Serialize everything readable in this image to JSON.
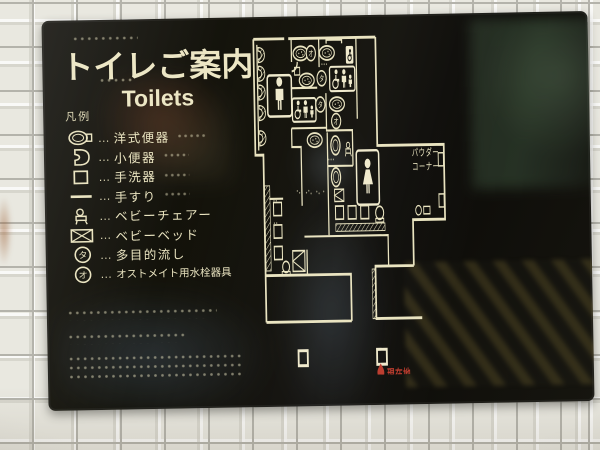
{
  "sign": {
    "title": "トイレご案内",
    "subtitle": "Toilets",
    "legend": {
      "heading": "凡例",
      "separator": "…",
      "items": [
        {
          "icon": "western-toilet-icon",
          "label": "洋式便器"
        },
        {
          "icon": "urinal-icon",
          "label": "小便器"
        },
        {
          "icon": "hand-wash-basin-icon",
          "label": "手洗器"
        },
        {
          "icon": "handrail-icon",
          "label": "手すり"
        },
        {
          "icon": "baby-chair-icon",
          "label": "ベビーチェアー"
        },
        {
          "icon": "baby-bed-icon",
          "label": "ベビーベッド"
        },
        {
          "icon": "multipurpose-sink-icon",
          "label": "多目的流し"
        },
        {
          "icon": "ostomate-fixture-icon",
          "label": "オストメイト用水栓器具"
        }
      ]
    },
    "map": {
      "powder_corner_line1": "パウダー",
      "powder_corner_line2": "コーナー",
      "symbol_multipurpose": "タ",
      "symbol_ostomate": "オ",
      "current_location_label": "現在地"
    },
    "colors": {
      "panel_black": "#121109",
      "print_cream": "#e9e3bf",
      "marker_red": "#bb3a2c"
    }
  }
}
